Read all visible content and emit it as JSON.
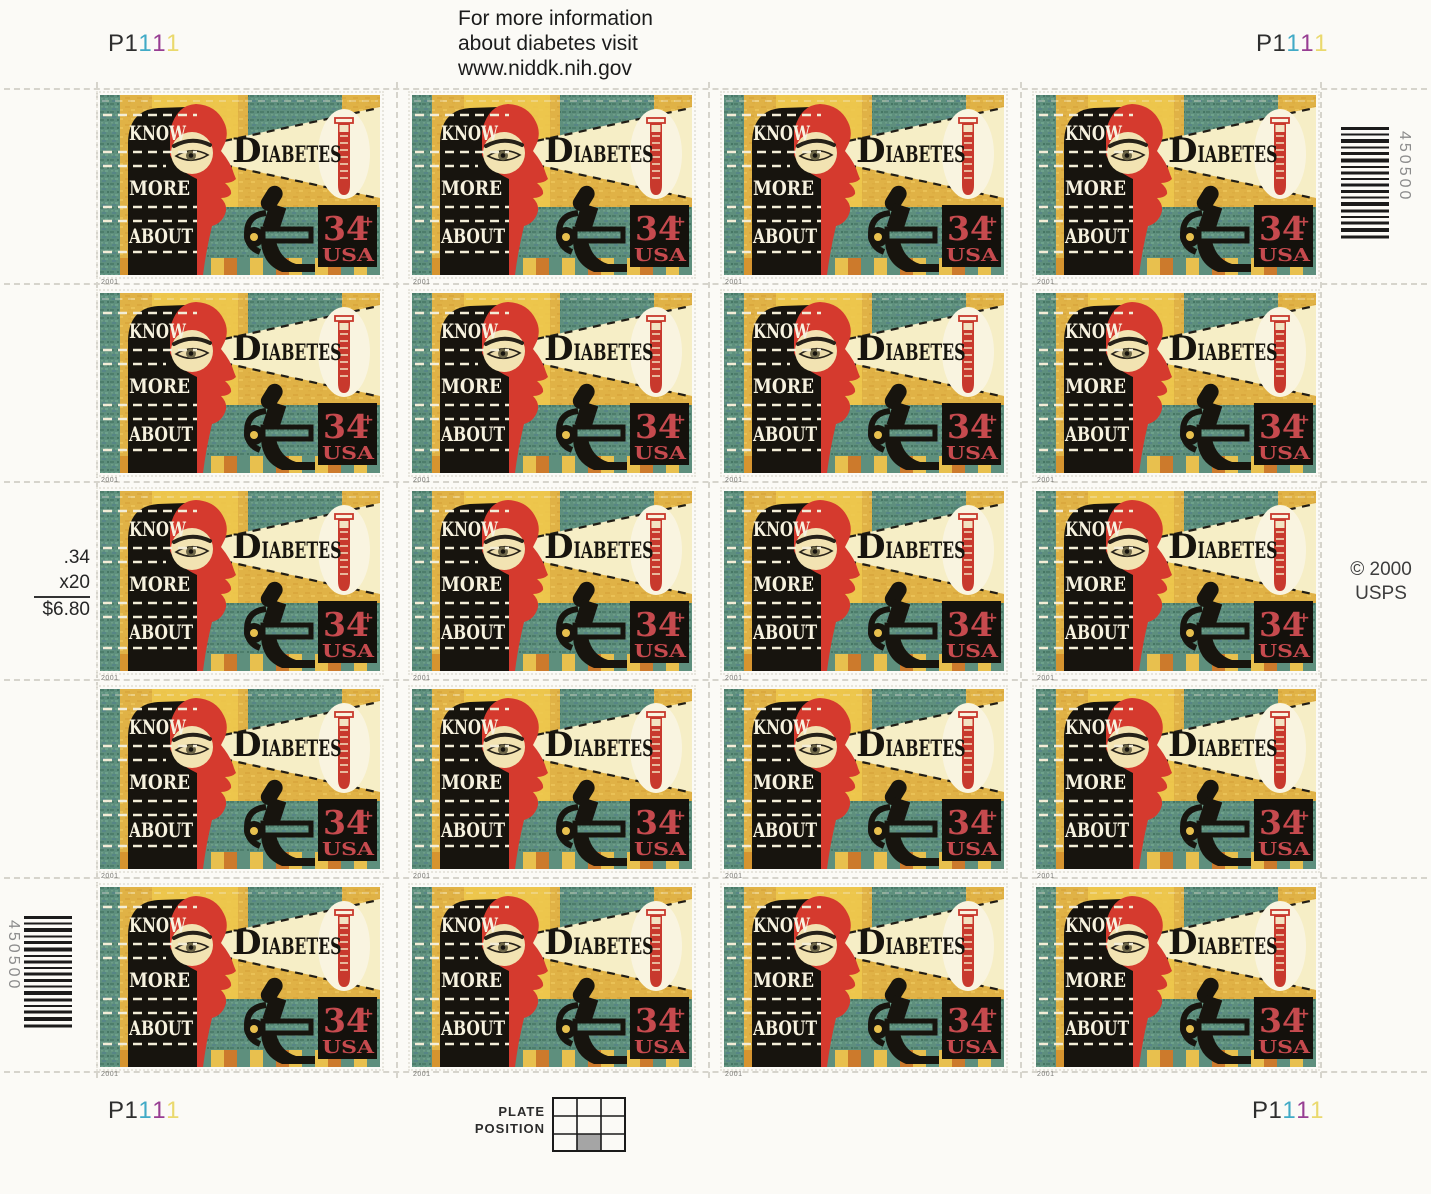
{
  "sheet": {
    "title": "Know More About Diabetes 34c stamp sheet",
    "info_lines": [
      "For more information",
      "about diabetes visit",
      "www.niddk.nih.gov"
    ],
    "plate_number": "P1111",
    "plate_digits": [
      {
        "ch": "P",
        "color": "#2e2e2e"
      },
      {
        "ch": "1",
        "color": "#2e2e2e"
      },
      {
        "ch": "1",
        "color": "#41aac6"
      },
      {
        "ch": "1",
        "color": "#973d92"
      },
      {
        "ch": "1",
        "color": "#ead96d"
      }
    ],
    "price": {
      "unit": ".34",
      "qty": "x20",
      "total": "$6.80"
    },
    "copyright": {
      "line1": "© 2000",
      "line2": "USPS"
    },
    "barcode_value": "450500",
    "plate_position": {
      "line1": "PLATE",
      "line2": "POSITION",
      "grid_rows": 3,
      "grid_cols": 3,
      "shaded_cell": "bottom-middle"
    },
    "grid": {
      "rows": 5,
      "cols": 4,
      "count": 20
    }
  },
  "stamp": {
    "know": "KNOW",
    "more": "MORE",
    "about": "ABOUT",
    "title_initial": "D",
    "title_rest": "IABETES",
    "denomination": "34",
    "cent_mark": "+",
    "country": "USA",
    "year": "2001",
    "colors": {
      "mustard": "#e0b246",
      "bright_yellow": "#efc94e",
      "teal": "#5e8f7d",
      "face_red": "#d53a2e",
      "ink_black": "#17140e",
      "beam_cream": "#f6eec6",
      "stamp_red": "#c64a4e",
      "oval_white": "#f9f4e0"
    }
  }
}
